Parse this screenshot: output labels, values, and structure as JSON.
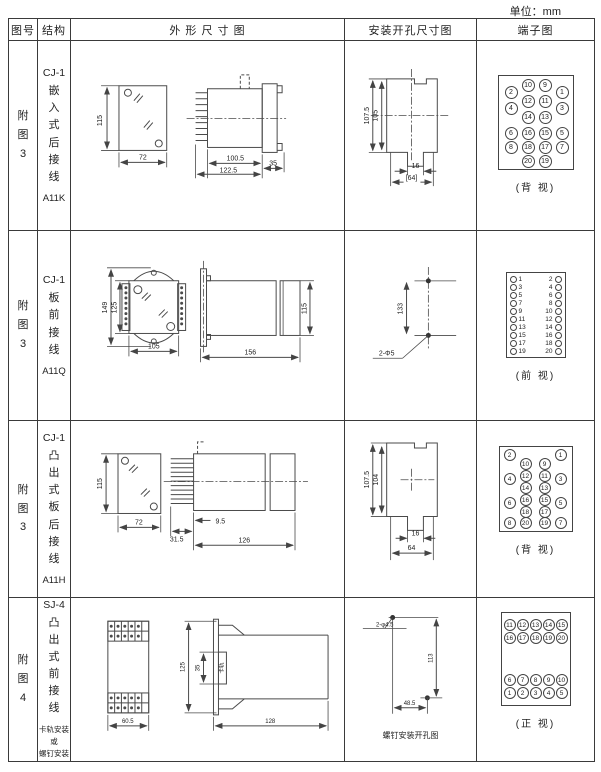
{
  "unit_label": "单位：mm",
  "headers": [
    "图号",
    "结构",
    "外 形 尺 寸 图",
    "安装开孔尺寸图",
    "端子图"
  ],
  "rows": [
    {
      "fig_no": "附\n图\n3",
      "model": "CJ-1",
      "structure_chars": "嵌\n入\n式\n后\n接\n线",
      "code": "A11K",
      "outline_dims": {
        "front_height": "115",
        "front_width": "72",
        "side_body": "100.5",
        "side_total": "122.5",
        "side_flange": "35"
      },
      "install_dims": {
        "outer_height": "107.5",
        "inner_height": "105",
        "notch_width": "16",
        "overall_width": "[64]"
      },
      "terminal": {
        "caption": "(背 视)",
        "circles": [
          {
            "n": "10",
            "x": 23,
            "y": 3
          },
          {
            "n": "9",
            "x": 40,
            "y": 3
          },
          {
            "n": "2",
            "x": 6,
            "y": 10
          },
          {
            "n": "1",
            "x": 57,
            "y": 10
          },
          {
            "n": "12",
            "x": 23,
            "y": 19
          },
          {
            "n": "11",
            "x": 40,
            "y": 19
          },
          {
            "n": "4",
            "x": 6,
            "y": 26
          },
          {
            "n": "3",
            "x": 57,
            "y": 26
          },
          {
            "n": "14",
            "x": 23,
            "y": 35
          },
          {
            "n": "13",
            "x": 40,
            "y": 35
          },
          {
            "n": "6",
            "x": 6,
            "y": 51
          },
          {
            "n": "16",
            "x": 23,
            "y": 51
          },
          {
            "n": "15",
            "x": 40,
            "y": 51
          },
          {
            "n": "5",
            "x": 57,
            "y": 51
          },
          {
            "n": "8",
            "x": 6,
            "y": 65
          },
          {
            "n": "18",
            "x": 23,
            "y": 65
          },
          {
            "n": "17",
            "x": 40,
            "y": 65
          },
          {
            "n": "7",
            "x": 57,
            "y": 65
          },
          {
            "n": "20",
            "x": 23,
            "y": 79
          },
          {
            "n": "19",
            "x": 40,
            "y": 79
          }
        ]
      }
    },
    {
      "fig_no": "附\n图\n3",
      "model": "CJ-1",
      "structure_chars": "板\n前\n接\n线",
      "code": "A11Q",
      "outline_dims": {
        "front_outer_height": "149",
        "front_inner_height": "125",
        "front_width": "105",
        "side_length": "156",
        "side_height": "115"
      },
      "install_dims": {
        "hole_spacing": "133",
        "hole_label": "2-Φ5"
      },
      "terminal": {
        "caption": "(前 视)",
        "pairs": [
          [
            "1",
            "2"
          ],
          [
            "3",
            "4"
          ],
          [
            "5",
            "6"
          ],
          [
            "7",
            "8"
          ],
          [
            "9",
            "10"
          ],
          [
            "11",
            "12"
          ],
          [
            "13",
            "14"
          ],
          [
            "15",
            "16"
          ],
          [
            "17",
            "18"
          ],
          [
            "19",
            "20"
          ]
        ]
      }
    },
    {
      "fig_no": "附\n图\n3",
      "model": "CJ-1",
      "structure_chars": "凸\n出\n式\n板\n后\n接\n线",
      "code": "A11H",
      "outline_dims": {
        "front_height": "115",
        "front_width": "72",
        "side_pins": "31.5",
        "side_gap": "9.5",
        "side_body": "126"
      },
      "install_dims": {
        "outer_height": "107.5",
        "inner_height": "104",
        "notch_width": "16",
        "overall_width": "64"
      },
      "terminal": {
        "caption": "(背 视)",
        "circles": [
          {
            "n": "2",
            "x": 4,
            "y": 2
          },
          {
            "n": "1",
            "x": 55,
            "y": 2
          },
          {
            "n": "10",
            "x": 20,
            "y": 11
          },
          {
            "n": "9",
            "x": 39,
            "y": 11
          },
          {
            "n": "12",
            "x": 20,
            "y": 23
          },
          {
            "n": "11",
            "x": 39,
            "y": 23
          },
          {
            "n": "4",
            "x": 4,
            "y": 26
          },
          {
            "n": "3",
            "x": 55,
            "y": 26
          },
          {
            "n": "14",
            "x": 20,
            "y": 35
          },
          {
            "n": "13",
            "x": 39,
            "y": 35
          },
          {
            "n": "16",
            "x": 20,
            "y": 47
          },
          {
            "n": "15",
            "x": 39,
            "y": 47
          },
          {
            "n": "6",
            "x": 4,
            "y": 50
          },
          {
            "n": "5",
            "x": 55,
            "y": 50
          },
          {
            "n": "18",
            "x": 20,
            "y": 59
          },
          {
            "n": "17",
            "x": 39,
            "y": 59
          },
          {
            "n": "8",
            "x": 4,
            "y": 70
          },
          {
            "n": "20",
            "x": 20,
            "y": 70
          },
          {
            "n": "19",
            "x": 39,
            "y": 70
          },
          {
            "n": "7",
            "x": 55,
            "y": 70
          }
        ]
      }
    },
    {
      "fig_no": "附\n图\n4",
      "model": "SJ-4",
      "structure_chars": "凸\n出\n式\n前\n接\n线",
      "mount_note": "卡轨安装\n或\n螺钉安装",
      "outline_dims": {
        "front_width": "60.5",
        "side_height": "125",
        "side_inner": "35",
        "rail_label": "卡轨",
        "side_length": "128"
      },
      "install_dims": {
        "hole_label": "2-φ4.5",
        "vertical": "113",
        "horizontal": "48.5",
        "caption": "螺钉安装开孔图"
      },
      "terminal": {
        "caption": "(正 视)",
        "circles": [
          {
            "n": "11",
            "x": 2,
            "y": 6
          },
          {
            "n": "12",
            "x": 15,
            "y": 6
          },
          {
            "n": "13",
            "x": 28,
            "y": 6
          },
          {
            "n": "14",
            "x": 41,
            "y": 6
          },
          {
            "n": "15",
            "x": 54,
            "y": 6
          },
          {
            "n": "16",
            "x": 2,
            "y": 19
          },
          {
            "n": "17",
            "x": 15,
            "y": 19
          },
          {
            "n": "18",
            "x": 28,
            "y": 19
          },
          {
            "n": "19",
            "x": 41,
            "y": 19
          },
          {
            "n": "20",
            "x": 54,
            "y": 19
          },
          {
            "n": "6",
            "x": 2,
            "y": 61
          },
          {
            "n": "7",
            "x": 15,
            "y": 61
          },
          {
            "n": "8",
            "x": 28,
            "y": 61
          },
          {
            "n": "9",
            "x": 41,
            "y": 61
          },
          {
            "n": "10",
            "x": 54,
            "y": 61
          },
          {
            "n": "1",
            "x": 2,
            "y": 74
          },
          {
            "n": "2",
            "x": 15,
            "y": 74
          },
          {
            "n": "3",
            "x": 28,
            "y": 74
          },
          {
            "n": "4",
            "x": 41,
            "y": 74
          },
          {
            "n": "5",
            "x": 54,
            "y": 74
          }
        ]
      }
    }
  ]
}
